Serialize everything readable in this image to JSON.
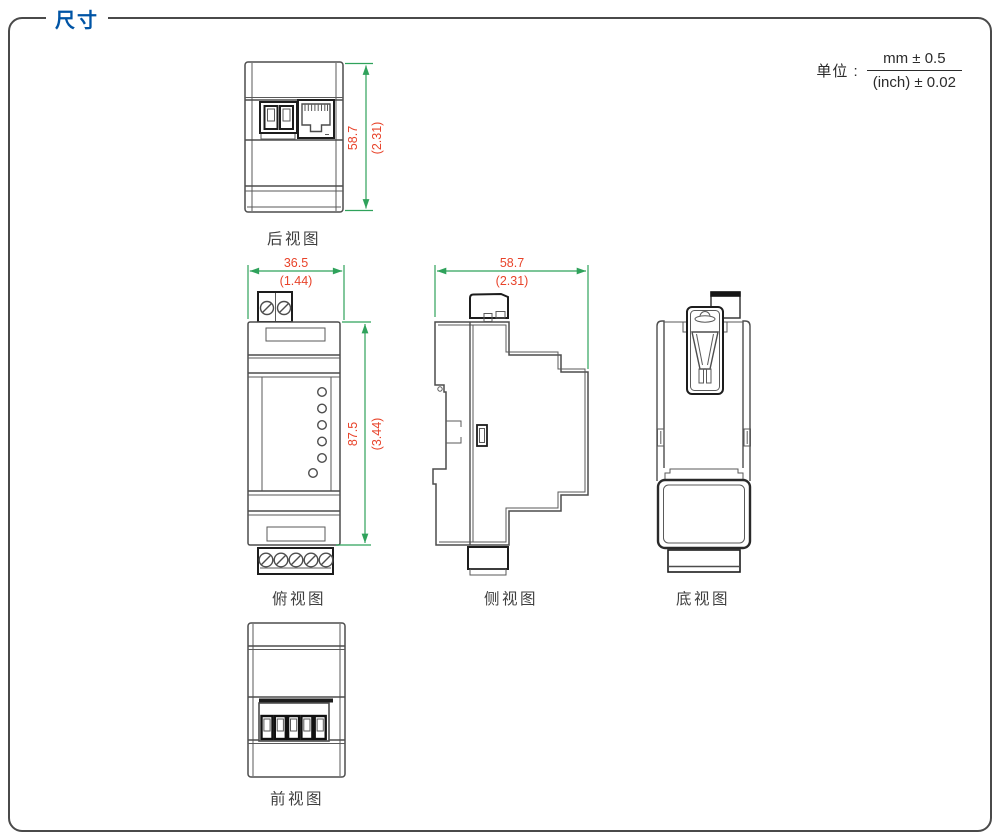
{
  "page": {
    "title": "尺寸",
    "units_label": "单位 :",
    "units_mm": "mm ± 0.5",
    "units_inch": "(inch) ± 0.02"
  },
  "views": {
    "rear": {
      "label": "后视图",
      "height_mm": "58.7",
      "height_inch": "(2.31)"
    },
    "top": {
      "label": "俯视图",
      "width_mm": "36.5",
      "width_inch": "(1.44)",
      "length_mm": "87.5",
      "length_inch": "(3.44)"
    },
    "side": {
      "label": "侧视图",
      "depth_mm": "58.7",
      "depth_inch": "(2.31)"
    },
    "bottom": {
      "label": "底视图"
    },
    "front": {
      "label": "前视图"
    }
  },
  "colors": {
    "title_blue": "#0054a5",
    "dimension_line_green": "#2fa25b",
    "dimension_text_red": "#e8432a",
    "drawing_line": "#4d4d4d",
    "connector_line": "#1d1d1d",
    "label_gray": "#3f3f3f"
  }
}
